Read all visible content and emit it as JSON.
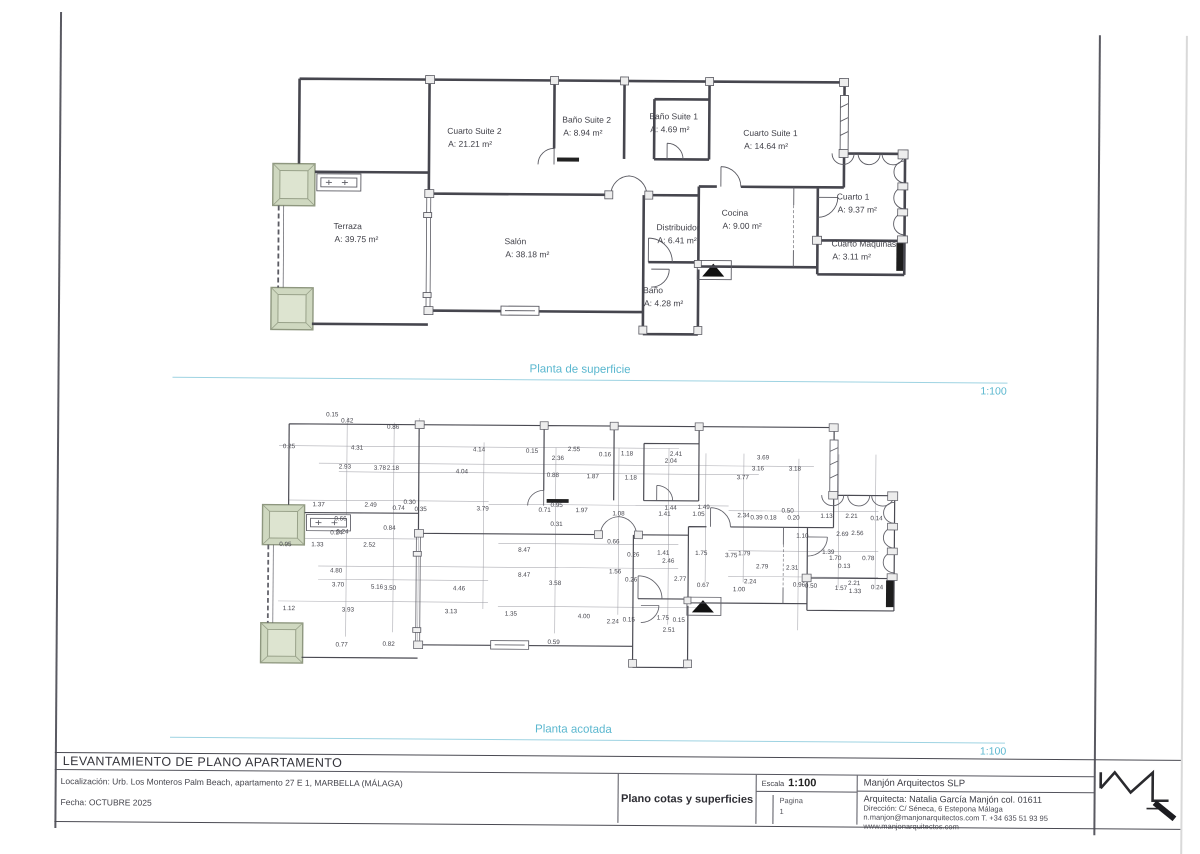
{
  "sheet": {
    "colors": {
      "accent_cyan": "#5ab7cf",
      "line": "#46464e",
      "planter_green": "#cfd8c0",
      "black_fill": "#1d1d1d"
    },
    "plan_top": {
      "title": "Planta de superficie",
      "scale": "1:100"
    },
    "plan_bottom": {
      "title": "Planta acotada",
      "scale": "1:100"
    },
    "rooms": [
      {
        "name": "Terraza",
        "area": "A: 39.75 m²",
        "x": 65,
        "y": 158
      },
      {
        "name": "Cuarto Suite 2",
        "area": "A:  21.21 m²",
        "x": 178,
        "y": 62
      },
      {
        "name": "Baño Suite 2",
        "area": "A:  8.94 m²",
        "x": 293,
        "y": 50
      },
      {
        "name": "Baño Suite 1",
        "area": "A:  4.69 m²",
        "x": 380,
        "y": 46
      },
      {
        "name": "Cuarto Suite 1",
        "area": "A:  14.64 m²",
        "x": 474,
        "y": 62
      },
      {
        "name": "Cuarto 1",
        "area": "A: 9.37 m²",
        "x": 568,
        "y": 125
      },
      {
        "name": "Cocina",
        "area": "A: 9.00 m²",
        "x": 453,
        "y": 142
      },
      {
        "name": "Distribuidor",
        "area": "A: 6.41 m²",
        "x": 388,
        "y": 157
      },
      {
        "name": "Cuarto Máquinas",
        "area": "A:  3.11 m²",
        "x": 563,
        "y": 172
      },
      {
        "name": "Salón",
        "area": "A: 38.18 m²",
        "x": 236,
        "y": 172
      },
      {
        "name": "Baño",
        "area": "A: 4.28 m²",
        "x": 375,
        "y": 220
      }
    ],
    "dims": [
      [
        "0.15",
        73,
        7
      ],
      [
        "0.42",
        88,
        13
      ],
      [
        "0.86",
        134,
        19
      ],
      [
        "0.25",
        30,
        39
      ],
      [
        "4.31",
        98,
        40
      ],
      [
        "2.93",
        86,
        59
      ],
      [
        "3.78",
        121,
        60
      ],
      [
        "2.18",
        134,
        60
      ],
      [
        "4.04",
        203,
        63
      ],
      [
        "4.14",
        220,
        41
      ],
      [
        "0.15",
        273,
        42
      ],
      [
        "2.55",
        315,
        40
      ],
      [
        "2.36",
        299,
        49
      ],
      [
        "0.16",
        346,
        45
      ],
      [
        "1.18",
        368,
        44
      ],
      [
        "2.41",
        417,
        44
      ],
      [
        "2.04",
        412,
        51
      ],
      [
        "3.69",
        504,
        47
      ],
      [
        "3.16",
        499,
        58
      ],
      [
        "3.18",
        536,
        58
      ],
      [
        "3.77",
        484,
        67
      ],
      [
        "0.88",
        294,
        66
      ],
      [
        "1.87",
        334,
        67
      ],
      [
        "1.18",
        372,
        68
      ],
      [
        "1.37",
        60,
        97
      ],
      [
        "2.49",
        112,
        97
      ],
      [
        "0.30",
        151,
        94
      ],
      [
        "0.74",
        140,
        100
      ],
      [
        "0.35",
        162,
        101
      ],
      [
        "0.66",
        82,
        111
      ],
      [
        "0.24",
        84,
        124
      ],
      [
        "0.84",
        131,
        120
      ],
      [
        "3.79",
        224,
        100
      ],
      [
        "0.71",
        286,
        101
      ],
      [
        "0.95",
        298,
        96
      ],
      [
        "1.97",
        323,
        101
      ],
      [
        "1.08",
        360,
        104
      ],
      [
        "1.44",
        412,
        98
      ],
      [
        "1.41",
        406,
        104
      ],
      [
        "1.49",
        445,
        97
      ],
      [
        "1.05",
        440,
        104
      ],
      [
        "2.34",
        485,
        105
      ],
      [
        "0.39",
        498,
        107
      ],
      [
        "0.18",
        512,
        107
      ],
      [
        "0.50",
        529,
        100
      ],
      [
        "0.20",
        535,
        107
      ],
      [
        "1.13",
        568,
        105
      ],
      [
        "2.21",
        593,
        105
      ],
      [
        "0.14",
        618,
        107
      ],
      [
        "0.31",
        298,
        115
      ],
      [
        "2.69",
        584,
        123
      ],
      [
        "2.56",
        599,
        122
      ],
      [
        "1.10",
        544,
        125
      ],
      [
        "0.95",
        27,
        137
      ],
      [
        "1.33",
        59,
        137
      ],
      [
        "2.52",
        111,
        137
      ],
      [
        "0.24",
        78,
        125
      ],
      [
        "4.80",
        78,
        163
      ],
      [
        "3.70",
        80,
        177
      ],
      [
        "5.16",
        119,
        179
      ],
      [
        "3.50",
        132,
        180
      ],
      [
        "4.46",
        201,
        180
      ],
      [
        "1.12",
        31,
        201
      ],
      [
        "3.93",
        90,
        202
      ],
      [
        "3.13",
        193,
        203
      ],
      [
        "0.77",
        84,
        237
      ],
      [
        "0.82",
        131,
        236
      ],
      [
        "8.47",
        266,
        141
      ],
      [
        "0.66",
        355,
        132
      ],
      [
        "0.26",
        375,
        145
      ],
      [
        "1.41",
        405,
        143
      ],
      [
        "1.75",
        443,
        143
      ],
      [
        "2.46",
        410,
        151
      ],
      [
        "8.47",
        266,
        166
      ],
      [
        "1.56",
        357,
        162
      ],
      [
        "3.58",
        297,
        174
      ],
      [
        "0.26",
        373,
        170
      ],
      [
        "2.77",
        422,
        169
      ],
      [
        "0.67",
        445,
        175
      ],
      [
        "1.35",
        253,
        205
      ],
      [
        "4.00",
        326,
        207
      ],
      [
        "2.24",
        355,
        212
      ],
      [
        "0.15",
        371,
        210
      ],
      [
        "1.75",
        405,
        208
      ],
      [
        "0.15",
        421,
        210
      ],
      [
        "2.51",
        411,
        220
      ],
      [
        "0.59",
        296,
        233
      ],
      [
        "3.75",
        473,
        145
      ],
      [
        "1.79",
        486,
        143
      ],
      [
        "1.39",
        570,
        141
      ],
      [
        "1.70",
        577,
        147
      ],
      [
        "0.78",
        610,
        147
      ],
      [
        "2.79",
        504,
        156
      ],
      [
        "2.31",
        534,
        157
      ],
      [
        "0.13",
        586,
        155
      ],
      [
        "2.24",
        492,
        171
      ],
      [
        "1.00",
        481,
        179
      ],
      [
        "0.96",
        541,
        174
      ],
      [
        "0.50",
        553,
        175
      ],
      [
        "1.57",
        583,
        177
      ],
      [
        "2.21",
        596,
        172
      ],
      [
        "1.33",
        597,
        180
      ],
      [
        "0.24",
        619,
        176
      ]
    ],
    "titleblock": {
      "project_title": "LEVANTAMIENTO DE PLANO APARTAMENTO",
      "location": "Localización:  Urb. Los Monteros Palm Beach, apartamento 27 E 1, MARBELLA (MÁLAGA)",
      "date": "Fecha: OCTUBRE 2025",
      "doc_title": "Plano cotas y superficies",
      "scale_label": "Escala",
      "scale_value": "1:100",
      "page_label": "Pagina",
      "page_value": "1",
      "firm": "Manjón Arquitectos SLP",
      "architect": "Arquitecta: Natalia García Manjón col. 01611",
      "address": "Dirección: C/ Séneca, 6 Estepona Málaga",
      "contact": "n.manjon@manjonarquitectos.com T. +34 635 51 93 95",
      "web": "www.manjonarquitectos.com"
    }
  }
}
